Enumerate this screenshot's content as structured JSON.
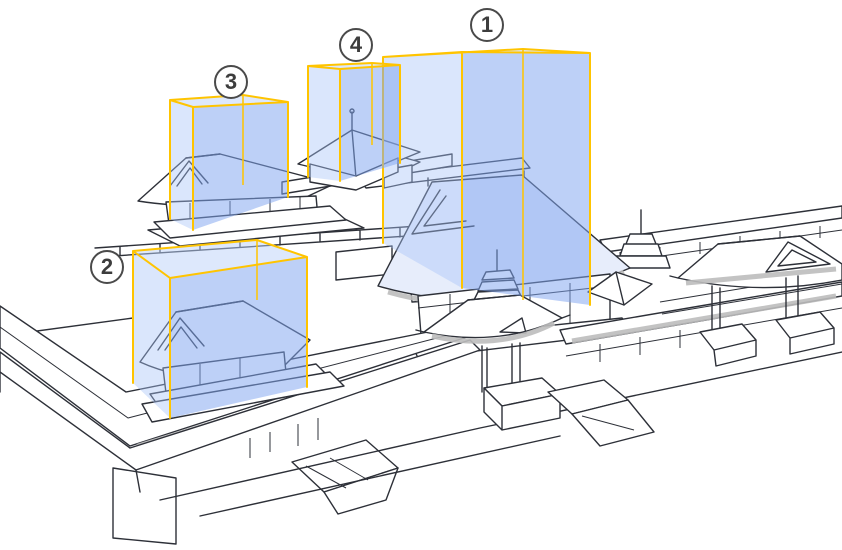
{
  "figure": {
    "type": "isometric-architecture-diagram",
    "subject": "temple-complex-overview-with-numbered-highlights",
    "markers": [
      {
        "id": 1,
        "label": "1",
        "x": 487,
        "y": 25
      },
      {
        "id": 2,
        "label": "2",
        "x": 107,
        "y": 267
      },
      {
        "id": 3,
        "label": "3",
        "x": 231,
        "y": 82
      },
      {
        "id": 4,
        "label": "4",
        "x": 356,
        "y": 45
      }
    ],
    "colors": {
      "background": "#FFFFFF",
      "line": "#2D3038",
      "shadow": "#BDBDBD",
      "roof_tint": "#E7EDFB",
      "highlight_edge": "#FFC400",
      "highlight_top": "rgba(187,209,250,0.50)",
      "highlight_left": "rgba(168,196,247,0.42)",
      "highlight_right": "rgba(128,165,240,0.52)",
      "marker_ring": "#4A4A4A",
      "marker_text": "#3D3D3D",
      "marker_fill": "#FFFFFF"
    }
  }
}
